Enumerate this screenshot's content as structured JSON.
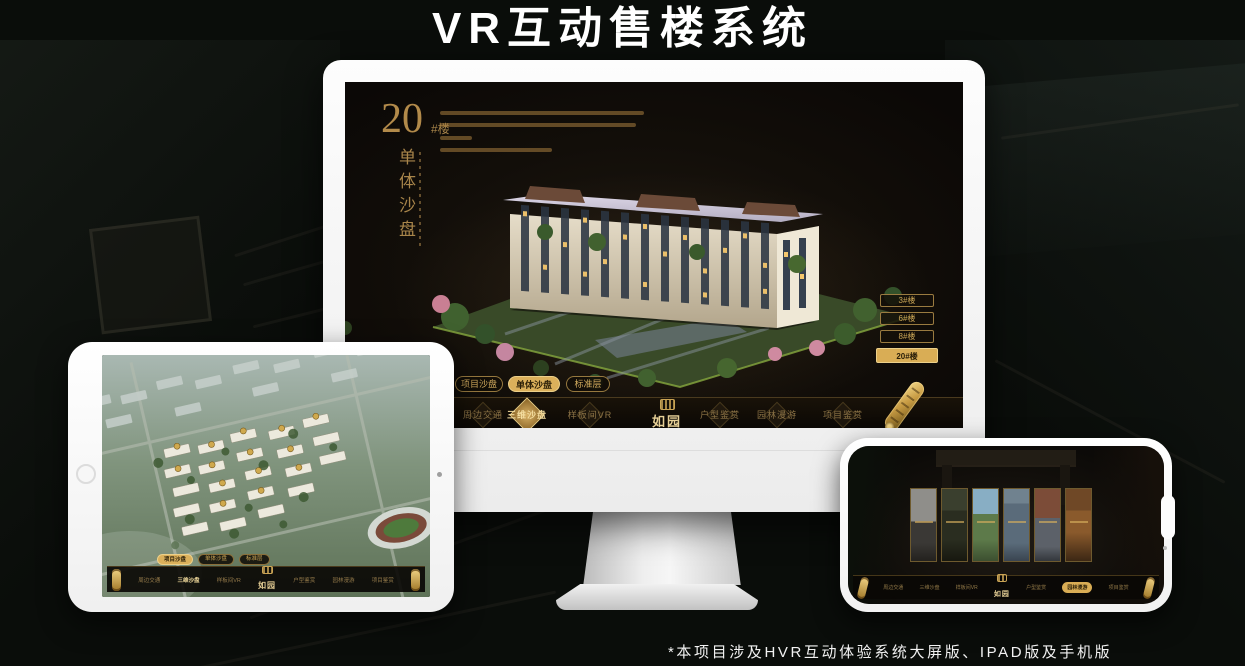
{
  "title": "VR互动售楼系统",
  "footnote": "*本项目涉及HVR互动体验系统大屏版、IPAD版及手机版",
  "brand": {
    "logo": "如园",
    "gold": "#c9a455",
    "gold_bright": "#dbb05b"
  },
  "tabs": [
    "项目沙盘",
    "单体沙盘",
    "标准层"
  ],
  "nav": {
    "items": [
      "周边交通",
      "三维沙盘",
      "样板间VR",
      "户型鉴赏",
      "园林漫游",
      "项目鉴赏"
    ]
  },
  "monitor": {
    "building_no": "20",
    "building_suffix": "#楼",
    "building_title": "单体沙盘",
    "floor_buttons": [
      "3#楼",
      "6#楼",
      "8#楼",
      "20#楼"
    ],
    "active_floor": "20#楼",
    "active_tab": "单体沙盘",
    "active_nav": "三维沙盘"
  },
  "tablet": {
    "active_tab": "项目沙盘",
    "active_nav": "三维沙盘"
  },
  "phone": {
    "active_nav": "园林漫游"
  }
}
